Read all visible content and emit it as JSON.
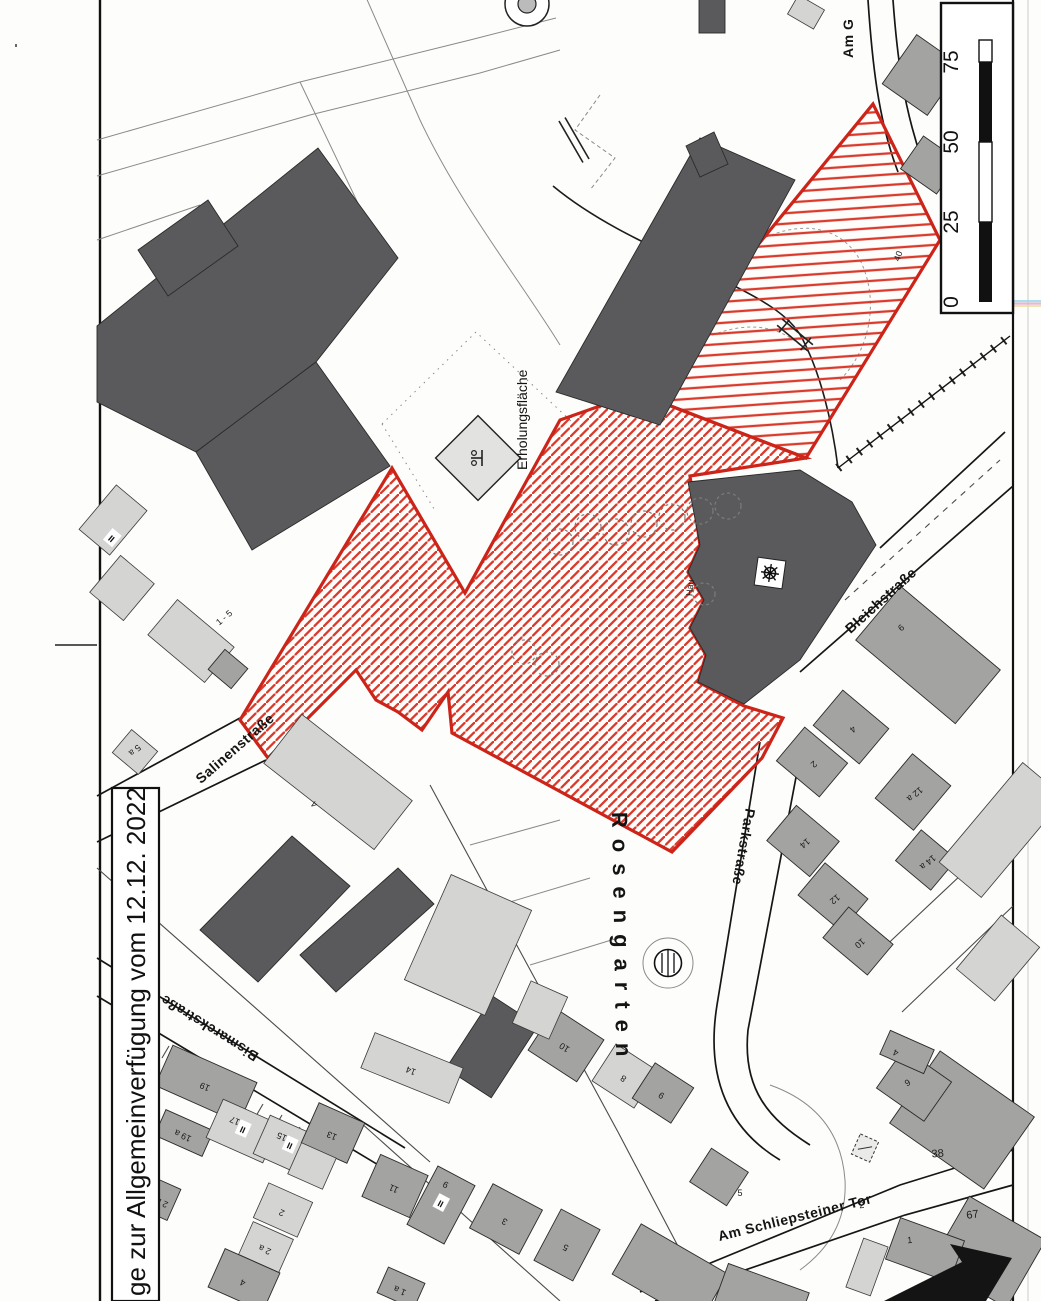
{
  "annotation_box": {
    "text": "ge zur Allgemeinverfügung vom 12.12. 2022"
  },
  "scale_bar": {
    "ticks": [
      "0",
      "25",
      "50",
      "75"
    ]
  },
  "area_labels": {
    "erholungsflaeche": "Erholungsfläche",
    "rosengarten": "Rosengarten"
  },
  "street_labels": {
    "salinenstrasse": "Salinenstraße",
    "bleichstrasse": "Bleichstraße",
    "parkstrasse": "Parkstraße",
    "bismarckstrasse": "Bismarckstraße",
    "am_schliepsteiner_tor": "Am Schliepsteiner Tor",
    "am_g": "Am G"
  },
  "symbols": {
    "playground_icon": "playground-symbol",
    "monument_icon": "gear-symbol",
    "fountain_icon": "fountain-symbol",
    "north_arrow_icon": "arrow-symbol"
  },
  "small_labels": [
    {
      "text": "40",
      "x": 901,
      "y": 257,
      "rot": -70
    },
    {
      "text": "Hau",
      "x": 693,
      "y": 588,
      "rot": -85
    }
  ],
  "floor_marks": [
    {
      "text": "II",
      "x": 243,
      "y": 1129,
      "rot": 24
    },
    {
      "text": "II",
      "x": 290,
      "y": 1145,
      "rot": 24
    },
    {
      "text": "II",
      "x": 441,
      "y": 1203,
      "rot": 28
    },
    {
      "text": "II",
      "x": 112,
      "y": 538,
      "rot": 40
    }
  ],
  "buildings": [
    {
      "x": 922,
      "y": 75,
      "w": 55,
      "h": 60,
      "rot": 35,
      "s": "M"
    },
    {
      "x": 930,
      "y": 165,
      "w": 44,
      "h": 40,
      "rot": 35,
      "s": "M"
    },
    {
      "x": 712,
      "y": 16,
      "w": 26,
      "h": 34,
      "rot": 0,
      "s": "D"
    },
    {
      "x": 806,
      "y": 12,
      "w": 30,
      "h": 22,
      "rot": 30,
      "s": "L"
    },
    {
      "x": 928,
      "y": 655,
      "w": 130,
      "h": 70,
      "rot": 40,
      "s": "M",
      "label": "6",
      "lx": 903,
      "ly": 630,
      "lrot": -40
    },
    {
      "x": 851,
      "y": 727,
      "w": 60,
      "h": 46,
      "rot": 40,
      "s": "M",
      "label": "4",
      "lrot": 140
    },
    {
      "x": 812,
      "y": 762,
      "w": 56,
      "h": 44,
      "rot": 40,
      "s": "M",
      "label": "2",
      "lrot": 140
    },
    {
      "x": 913,
      "y": 792,
      "w": 50,
      "h": 58,
      "rot": 40,
      "s": "M",
      "label": "12 a",
      "lrot": 140
    },
    {
      "x": 926,
      "y": 860,
      "w": 46,
      "h": 40,
      "rot": 40,
      "s": "M",
      "label": "14 a",
      "lrot": 140
    },
    {
      "x": 803,
      "y": 841,
      "w": 56,
      "h": 46,
      "rot": 40,
      "s": "M",
      "label": "14",
      "lrot": 140
    },
    {
      "x": 833,
      "y": 897,
      "w": 56,
      "h": 42,
      "rot": 40,
      "s": "M",
      "label": "12",
      "lrot": 140
    },
    {
      "x": 858,
      "y": 941,
      "w": 58,
      "h": 40,
      "rot": 40,
      "s": "M",
      "label": "10",
      "lrot": 140
    },
    {
      "x": 1002,
      "y": 830,
      "w": 55,
      "h": 130,
      "rot": 40,
      "s": "L"
    },
    {
      "x": 998,
      "y": 958,
      "w": 50,
      "h": 70,
      "rot": 40,
      "s": "L"
    },
    {
      "x": 492,
      "y": 1047,
      "w": 54,
      "h": 86,
      "rot": 33,
      "s": "D"
    },
    {
      "x": 566,
      "y": 1045,
      "w": 58,
      "h": 50,
      "rot": 33,
      "s": "M",
      "label": "10",
      "lrot": 213
    },
    {
      "x": 625,
      "y": 1076,
      "w": 50,
      "h": 44,
      "rot": 33,
      "s": "L",
      "label": "8",
      "lrot": 213
    },
    {
      "x": 663,
      "y": 1093,
      "w": 46,
      "h": 42,
      "rot": 33,
      "s": "M",
      "label": "9",
      "lrot": 213
    },
    {
      "x": 719,
      "y": 1177,
      "w": 44,
      "h": 40,
      "rot": 33,
      "s": "M",
      "label": "5",
      "lx": 740,
      "ly": 1196,
      "lrot": 0
    },
    {
      "x": 441,
      "y": 1205,
      "w": 42,
      "h": 66,
      "rot": 28,
      "s": "M",
      "label": "9",
      "lx": 447,
      "ly": 1182,
      "lrot": 208
    },
    {
      "x": 506,
      "y": 1219,
      "w": 56,
      "h": 50,
      "rot": 28,
      "s": "M",
      "label": "3",
      "lrot": 208
    },
    {
      "x": 567,
      "y": 1245,
      "w": 44,
      "h": 58,
      "rot": 28,
      "s": "M",
      "label": "5",
      "lrot": 208
    },
    {
      "x": 670,
      "y": 1274,
      "w": 100,
      "h": 58,
      "rot": 30,
      "s": "M"
    },
    {
      "x": 762,
      "y": 1297,
      "w": 86,
      "h": 40,
      "rot": 20,
      "s": "M"
    },
    {
      "x": 206,
      "y": 1084,
      "w": 92,
      "h": 44,
      "rot": 24,
      "s": "M",
      "label": "19",
      "lrot": 204
    },
    {
      "x": 184,
      "y": 1133,
      "w": 52,
      "h": 28,
      "rot": 24,
      "s": "M",
      "label": "19 a",
      "lrot": 204
    },
    {
      "x": 163,
      "y": 1200,
      "w": 24,
      "h": 34,
      "rot": 24,
      "s": "M",
      "label": "2 b",
      "lrot": 204
    },
    {
      "x": 243,
      "y": 1131,
      "w": 62,
      "h": 42,
      "rot": 24,
      "s": "L",
      "label": "17",
      "lx": 236,
      "ly": 1118,
      "lrot": 204
    },
    {
      "x": 290,
      "y": 1147,
      "w": 62,
      "h": 42,
      "rot": 24,
      "s": "L",
      "label": "15",
      "lx": 283,
      "ly": 1134,
      "lrot": 204
    },
    {
      "x": 333,
      "y": 1133,
      "w": 50,
      "h": 44,
      "rot": 24,
      "s": "M",
      "label": "13",
      "lrot": 204
    },
    {
      "x": 312,
      "y": 1166,
      "w": 38,
      "h": 34,
      "rot": 24,
      "s": "L"
    },
    {
      "x": 395,
      "y": 1186,
      "w": 52,
      "h": 46,
      "rot": 24,
      "s": "M",
      "label": "11",
      "lrot": 204
    },
    {
      "x": 283,
      "y": 1210,
      "w": 48,
      "h": 38,
      "rot": 24,
      "s": "L",
      "label": "2",
      "lrot": 204
    },
    {
      "x": 266,
      "y": 1247,
      "w": 44,
      "h": 36,
      "rot": 24,
      "s": "L",
      "label": "2 a",
      "lrot": 204
    },
    {
      "x": 244,
      "y": 1280,
      "w": 60,
      "h": 42,
      "rot": 24,
      "s": "M",
      "label": "4",
      "lrot": 204
    },
    {
      "x": 401,
      "y": 1288,
      "w": 40,
      "h": 28,
      "rot": 24,
      "s": "M",
      "label": "1 a",
      "lrot": 204
    },
    {
      "x": 412,
      "y": 1068,
      "w": 95,
      "h": 38,
      "rot": 22,
      "s": "L",
      "label": "14",
      "lrot": 202
    },
    {
      "x": 962,
      "y": 1120,
      "w": 115,
      "h": 88,
      "rot": 35,
      "s": "M",
      "label": "38",
      "lx": 938,
      "ly": 1157,
      "lrot": -5,
      "big": true
    },
    {
      "x": 914,
      "y": 1085,
      "w": 58,
      "h": 48,
      "rot": 35,
      "s": "M",
      "label": "6",
      "lx": 906,
      "ly": 1080,
      "lrot": 150
    },
    {
      "x": 988,
      "y": 1252,
      "w": 88,
      "h": 78,
      "rot": 30,
      "s": "M",
      "label": "67",
      "lx": 973,
      "ly": 1218,
      "lrot": -8,
      "big": true
    },
    {
      "x": 925,
      "y": 1250,
      "w": 68,
      "h": 44,
      "rot": 20,
      "s": "M",
      "label": "1",
      "lx": 910,
      "ly": 1243,
      "lrot": -5
    },
    {
      "x": 867,
      "y": 1267,
      "w": 26,
      "h": 52,
      "rot": 20,
      "s": "L",
      "label": "2",
      "lx": 862,
      "ly": 1208,
      "lrot": -5
    },
    {
      "x": 907,
      "y": 1052,
      "w": 48,
      "h": 26,
      "rot": 24,
      "s": "M",
      "label": "4",
      "lx": 897,
      "ly": 1050,
      "lrot": 204
    },
    {
      "x": 113,
      "y": 520,
      "w": 40,
      "h": 58,
      "rot": 40,
      "s": "L"
    },
    {
      "x": 122,
      "y": 588,
      "w": 44,
      "h": 48,
      "rot": 40,
      "s": "L"
    },
    {
      "x": 191,
      "y": 641,
      "w": 74,
      "h": 46,
      "rot": 40,
      "s": "L",
      "label": "1 - 5",
      "lx": 226,
      "ly": 620,
      "lrot": -40
    },
    {
      "x": 228,
      "y": 669,
      "w": 30,
      "h": 26,
      "rot": 40,
      "s": "M"
    },
    {
      "x": 135,
      "y": 752,
      "w": 34,
      "h": 30,
      "rot": 40,
      "s": "L",
      "label": "5 a",
      "lx": 133,
      "ly": 748,
      "lrot": 140
    },
    {
      "x": 338,
      "y": 782,
      "w": 140,
      "h": 62,
      "rot": 38,
      "s": "L",
      "label": "4",
      "lx": 316,
      "ly": 802,
      "lrot": 218
    },
    {
      "x": 468,
      "y": 945,
      "w": 88,
      "h": 115,
      "rot": 24,
      "s": "L"
    },
    {
      "x": 540,
      "y": 1010,
      "w": 40,
      "h": 46,
      "rot": 24,
      "s": "L"
    }
  ],
  "colors": {
    "zone_red": "#cc2419",
    "hatch_red": "#d93a2c",
    "building_dark": "#5a5a5c",
    "building_mid": "#a3a3a1",
    "building_light": "#d4d4d2"
  }
}
